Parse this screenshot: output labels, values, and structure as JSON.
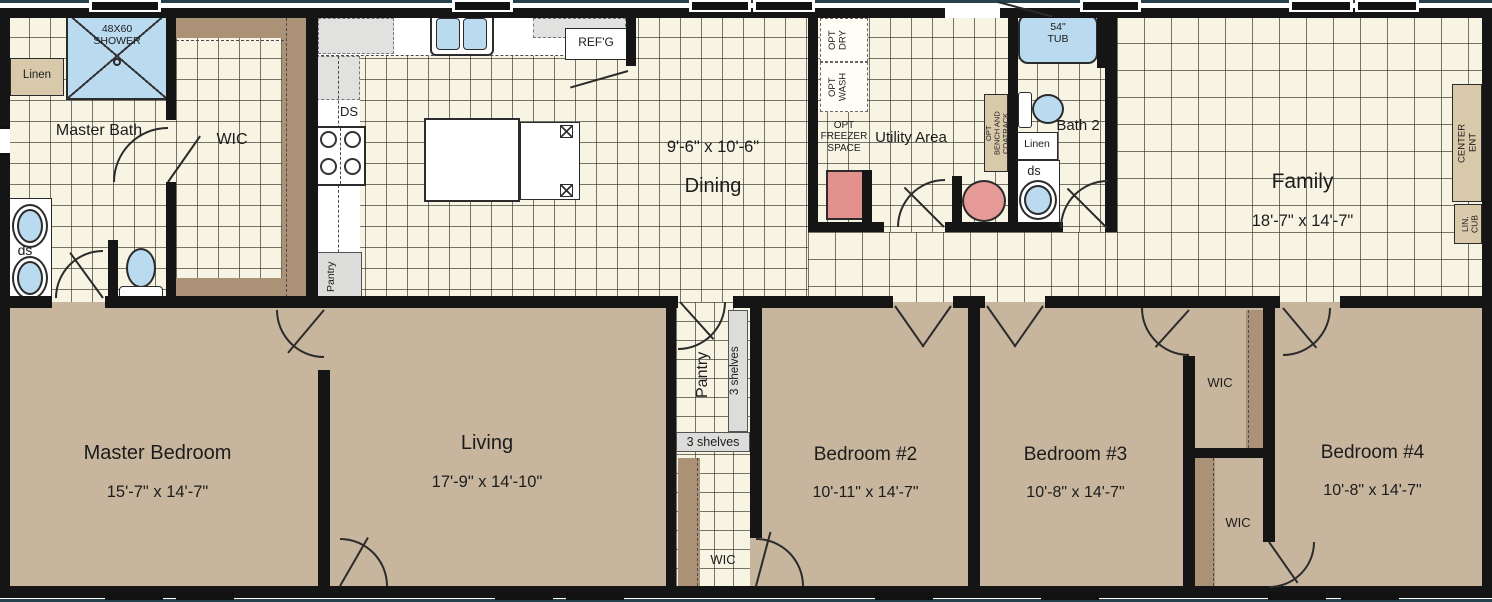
{
  "rooms": {
    "master_bath": {
      "name": "Master Bath"
    },
    "wic_master": {
      "name": "WIC"
    },
    "dining": {
      "size": "9'-6\" x 10'-6\"",
      "name": "Dining"
    },
    "utility": {
      "name": "Utility Area"
    },
    "bath2": {
      "name": "Bath 2"
    },
    "family": {
      "name": "Family",
      "size": "18'-7\" x 14'-7\""
    },
    "master_bedroom": {
      "name": "Master Bedroom",
      "size": "15'-7\" x 14'-7\""
    },
    "living": {
      "name": "Living",
      "size": "17'-9\" x 14'-10\""
    },
    "pantry": {
      "name": "Pantry"
    },
    "wic_hall": {
      "name": "WIC"
    },
    "bedroom2": {
      "name": "Bedroom #2",
      "size": "10'-11\" x 14'-7\""
    },
    "bedroom3": {
      "name": "Bedroom #3",
      "size": "10'-8\" x 14'-7\""
    },
    "wic_bedroom3": {
      "name": "WIC"
    },
    "wic_bedroom4": {
      "name": "WIC"
    },
    "bedroom4": {
      "name": "Bedroom #4",
      "size": "10'-8\" x 14'-7\""
    }
  },
  "fixtures": {
    "shower": "48X60\nSHOWER",
    "linen_master": "Linen",
    "ds_master": "ds",
    "ds_kitchen": "DS",
    "refrigerator": "REF'G",
    "pantry_kitchen": "Pantry",
    "opt_dry": "OPT\nDRY",
    "opt_wash": "OPT\nWASH",
    "opt_freezer": "OPT\nFREEZER\nSPACE",
    "opt_bench": "OPT\nBENCH AND\nCOATRACK",
    "linen_bath2": "Linen",
    "ds_bath2": "ds",
    "tub": "54\"\nTUB",
    "ent_center": "ENT\nCENTER",
    "cub_lin": "CUB\nLIN.",
    "shelves_pantry_side": "3 shelves",
    "shelves_pantry_bottom": "3 shelves"
  },
  "colors": {
    "wall": "#151515",
    "tile_floor": "#f8f4e4",
    "carpet": "#c7b69d",
    "wood_trim": "#ab9176",
    "fixture_blue": "#badaf0",
    "accent_pink": "#e2918f",
    "cabinet_tan": "#d9c9ab",
    "counter_gray": "#e1e1df"
  }
}
